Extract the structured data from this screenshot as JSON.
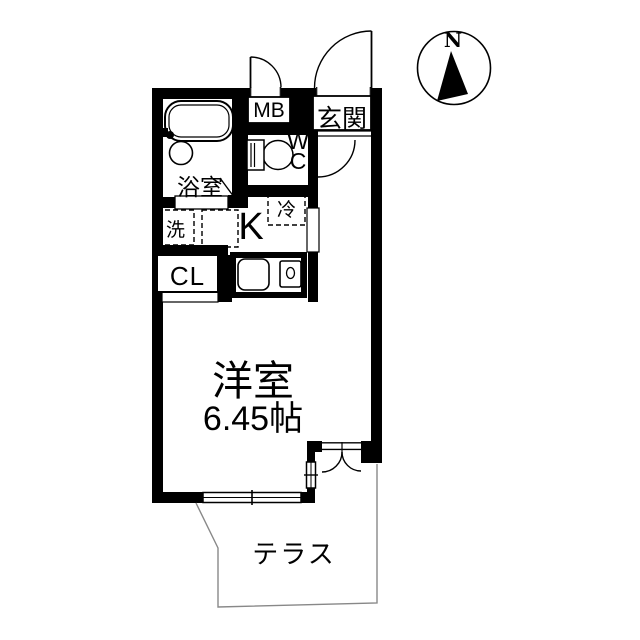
{
  "floorplan": {
    "compass": {
      "north_label": "N"
    },
    "labels": {
      "meter_box": "MB",
      "entrance": "玄関",
      "toilet": "WC",
      "bathroom": "浴室",
      "laundry": "洗",
      "refrigerator": "冷",
      "kitchen": "K",
      "closet": "CL",
      "western_room": "洋室",
      "western_room_size": "6.45帖",
      "terrace": "テラス"
    },
    "colors": {
      "wall": "#000000",
      "background": "#ffffff",
      "terrace_line": "#888888"
    }
  }
}
